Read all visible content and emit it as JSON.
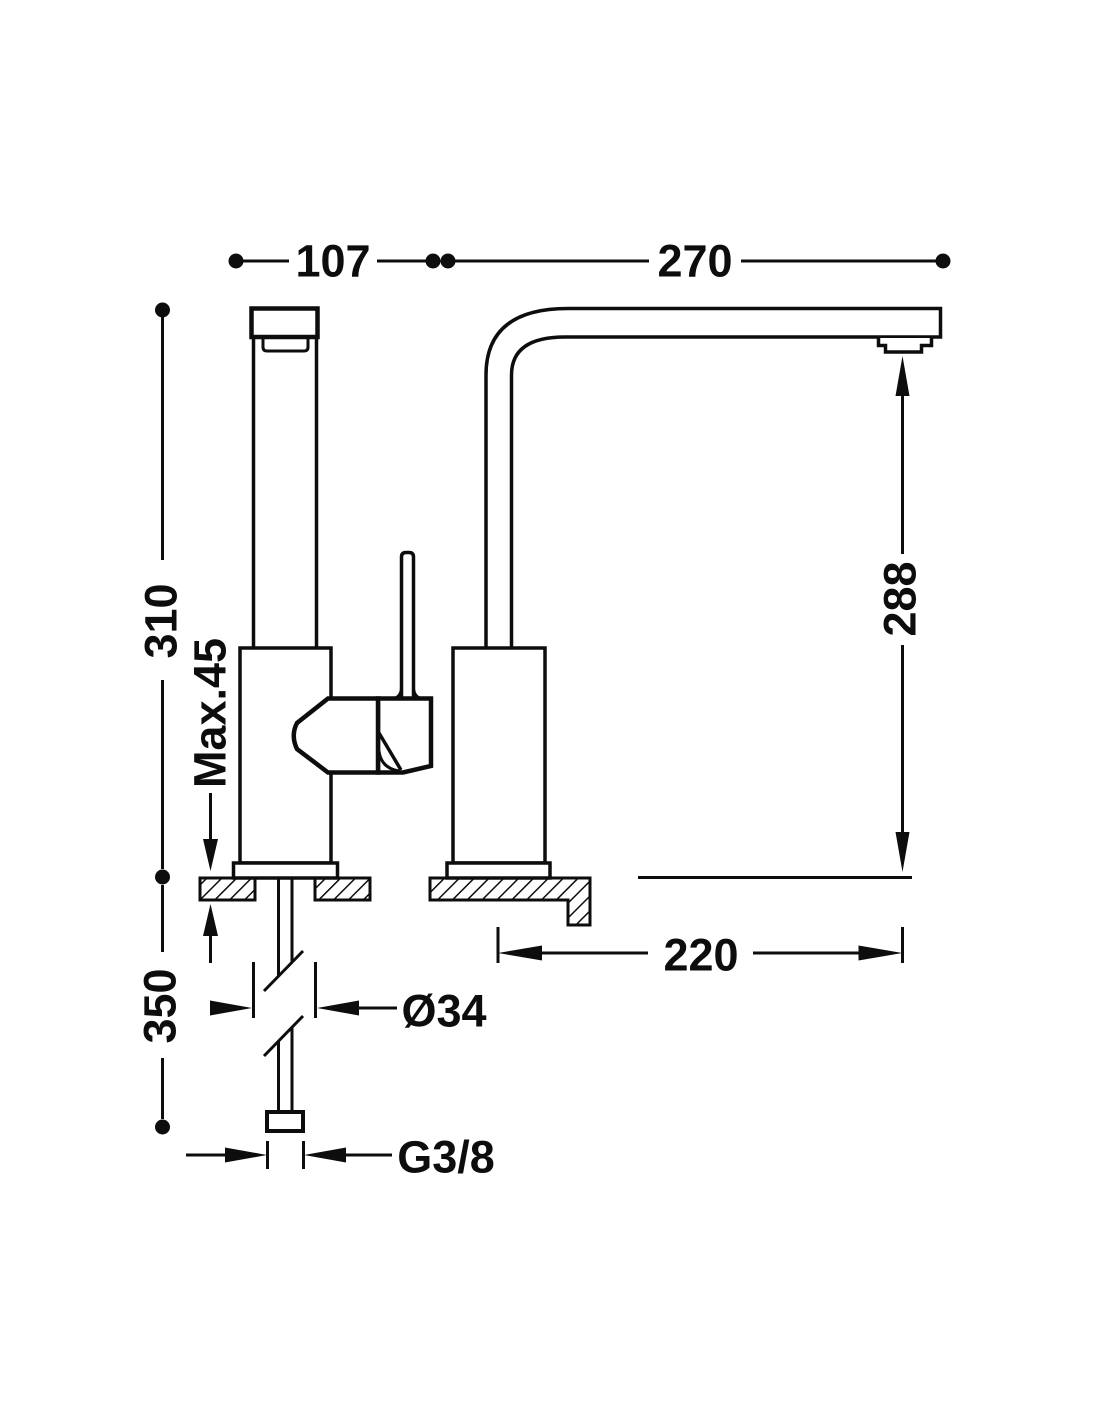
{
  "drawing": {
    "type": "faucet-technical-dimension-drawing",
    "dimensions": {
      "body_width": "107",
      "spout_top_length": "270",
      "height_above_counter": "310",
      "max_counter_thickness": "Max.45",
      "length_below_counter": "350",
      "outlet_height": "288",
      "spout_projection": "220",
      "base_diameter": "Ø34",
      "supply_thread": "G3/8"
    },
    "colors": {
      "line": "#0d0d0d",
      "background": "#ffffff"
    }
  }
}
